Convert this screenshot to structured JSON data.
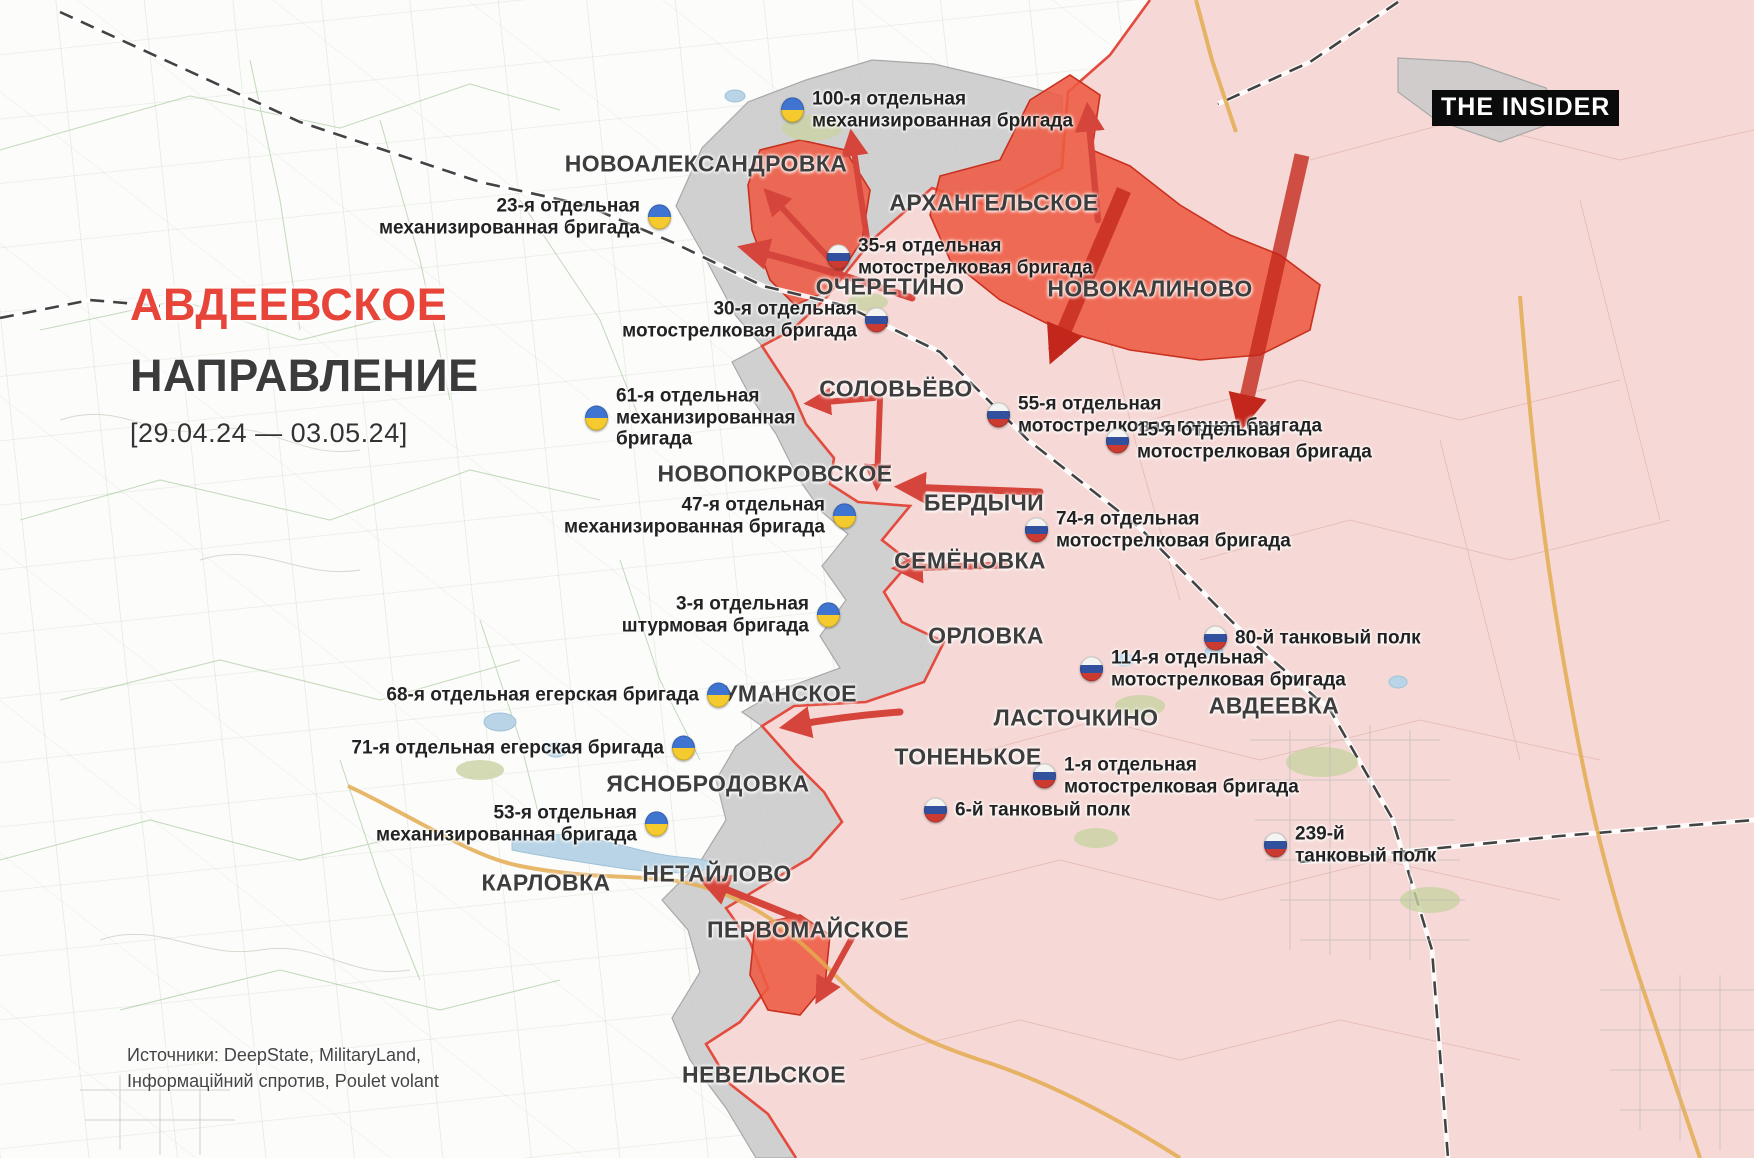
{
  "meta": {
    "brand": "THE INSIDER"
  },
  "title": {
    "line1": "АВДЕЕВСКОЕ",
    "line2": "НАПРАВЛЕНИЕ",
    "date_range": "[29.04.24 — 03.05.24]"
  },
  "sources": {
    "line1": "Источники: DeepState, MilitaryLand,",
    "line2": "Інформаційний спротив, Poulet volant"
  },
  "colors": {
    "title_red": "#e8453a",
    "title_dark": "#3b3b3b",
    "occupied_pink": "#f6d9d6",
    "contested_gray": "#c9c9c9",
    "advance_red": "#ee5a42",
    "advance_band_red": "#c3271b",
    "front_line_red": "#e34b3e",
    "arrow_red": "#d6453b",
    "ukraine_blue": "#3f74d0",
    "ukraine_yellow": "#f5ca2e",
    "russia_blue": "#31519e",
    "russia_red": "#cc3b31"
  },
  "settlements": [
    {
      "id": "novooleksandrivka",
      "name": "НОВОАЛЕКСАНДРОВКА",
      "x": 706,
      "y": 164
    },
    {
      "id": "arkhangelskoe",
      "name": "АРХАНГЕЛЬСКОЕ",
      "x": 994,
      "y": 203
    },
    {
      "id": "ocheretino",
      "name": "ОЧЕРЕТИНО",
      "x": 890,
      "y": 287
    },
    {
      "id": "novokalinovo",
      "name": "НОВОКАЛИНОВО",
      "x": 1150,
      "y": 289
    },
    {
      "id": "solovyovo",
      "name": "СОЛОВЬЁВО",
      "x": 896,
      "y": 389
    },
    {
      "id": "novopokrovskoe",
      "name": "НОВОПОКРОВСКОЕ",
      "x": 775,
      "y": 474
    },
    {
      "id": "berdychi",
      "name": "БЕРДЫЧИ",
      "x": 984,
      "y": 503
    },
    {
      "id": "semyonovka",
      "name": "СЕМЁНОВКА",
      "x": 970,
      "y": 561
    },
    {
      "id": "orlovka",
      "name": "ОРЛОВКА",
      "x": 986,
      "y": 636
    },
    {
      "id": "umanskoe",
      "name": "УМАНСКОЕ",
      "x": 790,
      "y": 694
    },
    {
      "id": "lastochkino",
      "name": "ЛАСТОЧКИНО",
      "x": 1076,
      "y": 718
    },
    {
      "id": "avdeevka",
      "name": "АВДЕЕВКА",
      "x": 1274,
      "y": 706
    },
    {
      "id": "yasnobrodovka",
      "name": "ЯСНОБРОДОВКА",
      "x": 708,
      "y": 784
    },
    {
      "id": "tonenkoe",
      "name": "ТОНЕНЬКОЕ",
      "x": 968,
      "y": 757
    },
    {
      "id": "karlovka",
      "name": "КАРЛОВКА",
      "x": 546,
      "y": 883
    },
    {
      "id": "netaylovo",
      "name": "НЕТАЙЛОВО",
      "x": 717,
      "y": 874
    },
    {
      "id": "pervomayskoe",
      "name": "ПЕРВОМАЙСКОЕ",
      "x": 808,
      "y": 930
    },
    {
      "id": "nevelskoe",
      "name": "НЕВЕЛЬСКОЕ",
      "x": 764,
      "y": 1075
    }
  ],
  "units": [
    {
      "id": "100-mech",
      "side": "ua",
      "flag_x": 794,
      "flag_y": 110,
      "text_side": "right",
      "lines": [
        "100-я отдельная",
        "механизированная бригада"
      ]
    },
    {
      "id": "23-mech",
      "side": "ua",
      "flag_x": 658,
      "flag_y": 217,
      "text_side": "left",
      "lines": [
        "23-я отдельная",
        "механизированная бригада"
      ]
    },
    {
      "id": "35-motor",
      "side": "ru",
      "flag_x": 840,
      "flag_y": 257,
      "text_side": "right",
      "lines": [
        "35-я отдельная",
        "мотострелковая бригада"
      ]
    },
    {
      "id": "30-motor",
      "side": "ru",
      "flag_x": 875,
      "flag_y": 320,
      "text_side": "left",
      "lines": [
        "30-я отдельная",
        "мотострелковая бригада"
      ]
    },
    {
      "id": "55-motor-mountain",
      "side": "ru",
      "flag_x": 1000,
      "flag_y": 415,
      "text_side": "right",
      "lines": [
        "55-я отдельная",
        "мотострелковая горная бригада"
      ]
    },
    {
      "id": "61-mech",
      "side": "ua",
      "flag_x": 598,
      "flag_y": 418,
      "text_side": "right",
      "lines": [
        "61-я отдельная",
        "механизированная",
        "бригада"
      ]
    },
    {
      "id": "15-motor",
      "side": "ru",
      "flag_x": 1119,
      "flag_y": 441,
      "text_side": "right",
      "lines": [
        "15-я отдельная",
        "мотострелковая бригада"
      ]
    },
    {
      "id": "47-mech",
      "side": "ua",
      "flag_x": 843,
      "flag_y": 516,
      "text_side": "left",
      "lines": [
        "47-я отдельная",
        "механизированная бригада"
      ]
    },
    {
      "id": "74-motor",
      "side": "ru",
      "flag_x": 1038,
      "flag_y": 530,
      "text_side": "right",
      "lines": [
        "74-я отдельная",
        "мотострелковая бригада"
      ]
    },
    {
      "id": "3-assault",
      "side": "ua",
      "flag_x": 827,
      "flag_y": 615,
      "text_side": "left",
      "lines": [
        "3-я отдельная",
        "штурмовая бригада"
      ]
    },
    {
      "id": "80-tank",
      "side": "ru",
      "flag_x": 1217,
      "flag_y": 638,
      "text_side": "right",
      "lines": [
        "80-й танковый полк"
      ]
    },
    {
      "id": "114-motor",
      "side": "ru",
      "flag_x": 1093,
      "flag_y": 669,
      "text_side": "right",
      "lines": [
        "114-я отдельная",
        "мотострелковая бригада"
      ]
    },
    {
      "id": "68-jaeger",
      "side": "ua",
      "flag_x": 717,
      "flag_y": 695,
      "text_side": "left",
      "lines": [
        "68-я отдельная егерская бригада"
      ]
    },
    {
      "id": "71-jaeger",
      "side": "ua",
      "flag_x": 682,
      "flag_y": 748,
      "text_side": "left",
      "lines": [
        "71-я отдельная егерская бригада"
      ]
    },
    {
      "id": "1-motor",
      "side": "ru",
      "flag_x": 1046,
      "flag_y": 776,
      "text_side": "right",
      "lines": [
        "1-я отдельная",
        "мотострелковая бригада"
      ]
    },
    {
      "id": "6-tank",
      "side": "ru",
      "flag_x": 937,
      "flag_y": 810,
      "text_side": "right",
      "lines": [
        "6-й танковый полк"
      ]
    },
    {
      "id": "53-mech",
      "side": "ua",
      "flag_x": 655,
      "flag_y": 824,
      "text_side": "left",
      "lines": [
        "53-я отдельная",
        "механизированная бригада"
      ]
    },
    {
      "id": "239-tank",
      "side": "ru",
      "flag_x": 1277,
      "flag_y": 845,
      "text_side": "right",
      "lines": [
        "239-й",
        "танковый полк"
      ]
    }
  ]
}
